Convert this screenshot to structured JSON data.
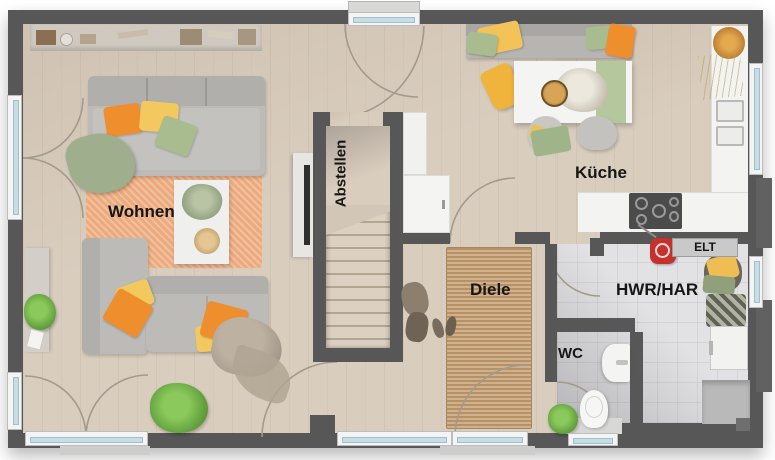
{
  "rooms": {
    "wohnen": "Wohnen",
    "abstellen": "Abstellen",
    "kueche": "Küche",
    "diele": "Diele",
    "hwr": "HWR/HAR",
    "wc": "WC",
    "elt": "ELT"
  },
  "palette": {
    "wall": "#575757",
    "wood_floor": "#d9cdbe",
    "tile_floor": "#e2e2e4",
    "rug_living": "#ecab7e",
    "rug_hall": "#c49e72",
    "sofa_gray": "#bdbbb7",
    "pillow_orange": "#ef8e2d",
    "pillow_yellow": "#f3c95f",
    "pillow_green": "#a8bc90",
    "plant_green": "#6fae4e",
    "window_glass": "#c6dde4",
    "counter_white": "#f3f3f1",
    "stairs_tread": "#dcd1c1"
  }
}
